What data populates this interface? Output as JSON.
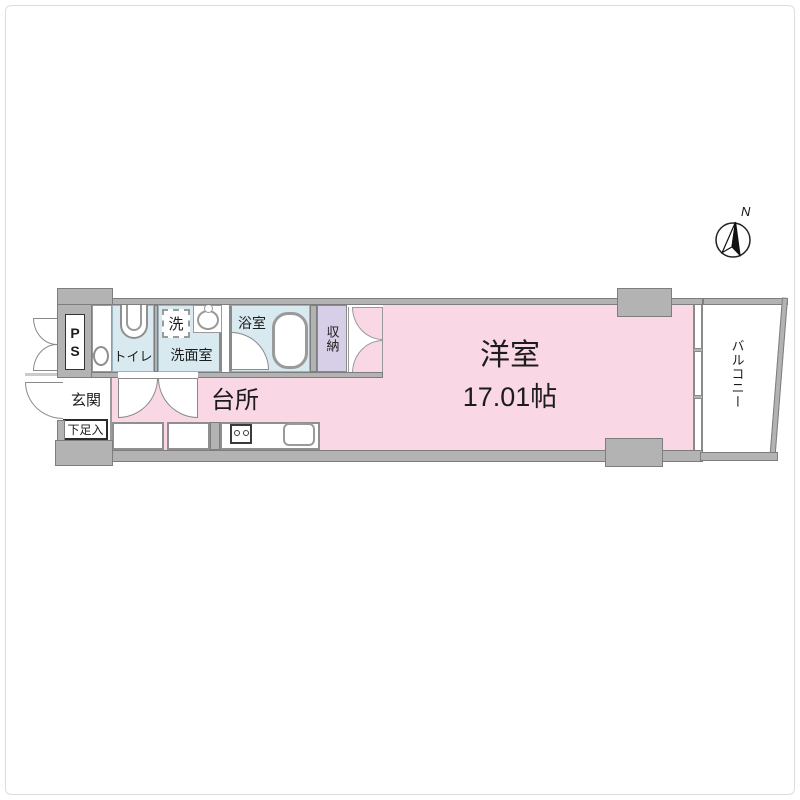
{
  "title": "apartment-floor-plan",
  "compass": {
    "north_label": "N"
  },
  "rooms": {
    "ps": {
      "label": "PS"
    },
    "toilet": {
      "label": "トイレ"
    },
    "washroom": {
      "label": "洗面室",
      "washer_label": "洗"
    },
    "bathroom": {
      "label": "浴室"
    },
    "storage": {
      "label": "収納"
    },
    "entrance": {
      "label": "玄関"
    },
    "shoe_cabinet": {
      "label": "下足入"
    },
    "kitchen": {
      "label": "台所"
    },
    "western_room": {
      "label": "洋室",
      "size": "17.01帖"
    },
    "balcony": {
      "label": "バルコニー"
    }
  },
  "colors": {
    "wall_fill": "#b3b3b3",
    "wall_edge": "#7d7d7d",
    "room_pink": "#f9d7e5",
    "wet_area_blue": "#d8eaf0",
    "storage_lavender": "#d6cfe7",
    "line_gray": "#8a8a8a"
  }
}
